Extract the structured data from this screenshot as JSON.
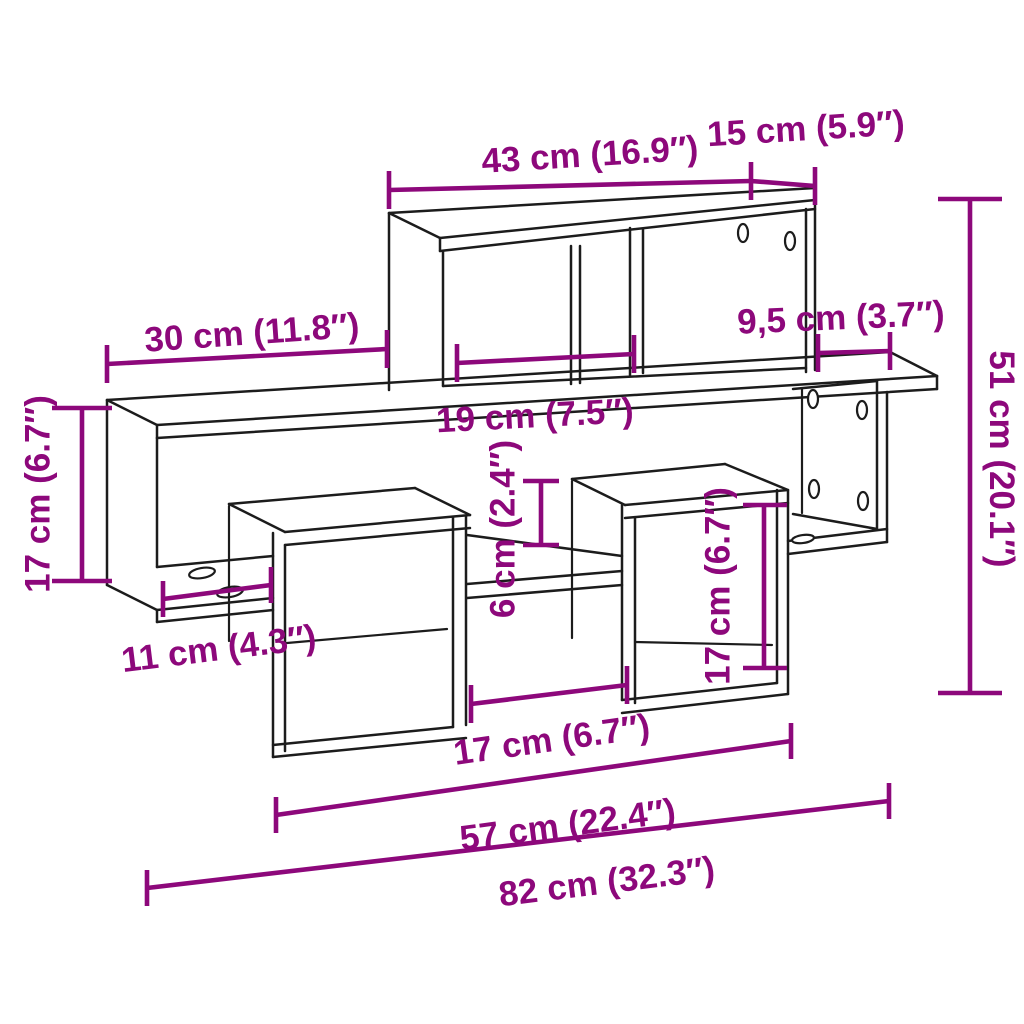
{
  "diagram": {
    "title": "Wall shelf dimension diagram",
    "colors": {
      "background": "#ffffff",
      "line": "#1c1c1c",
      "dimension": "#8d087b"
    },
    "units": {
      "metric": "cm",
      "imperial": "in"
    },
    "dims": [
      {
        "id": "top-shelf-width",
        "value_cm": "43",
        "value_in": "16.9",
        "label": "43 cm (16.9″)"
      },
      {
        "id": "top-right-width",
        "value_cm": "15",
        "value_in": "5.9",
        "label": "15 cm (5.9″)"
      },
      {
        "id": "left-shelf-width",
        "value_cm": "30",
        "value_in": "11.8",
        "label": "30 cm (11.8″)"
      },
      {
        "id": "right-overhang-width",
        "value_cm": "9,5",
        "value_in": "3.7",
        "label": "9,5 cm (3.7″)"
      },
      {
        "id": "middle-compartment",
        "value_cm": "19",
        "value_in": "7.5",
        "label": "19 cm (7.5″)"
      },
      {
        "id": "left-side-height",
        "value_cm": "17",
        "value_in": "6.7",
        "label": "17 cm (6.7″)"
      },
      {
        "id": "total-height",
        "value_cm": "51",
        "value_in": "20.1",
        "label": "51 cm (20.1″)"
      },
      {
        "id": "middle-gap-height",
        "value_cm": "6",
        "value_in": "2.4",
        "label": "6 cm (2.4″)"
      },
      {
        "id": "cube-height",
        "value_cm": "17",
        "value_in": "6.7",
        "label": "17 cm (6.7″)"
      },
      {
        "id": "left-board-width",
        "value_cm": "11",
        "value_in": "4.3",
        "label": "11 cm (4.3″)"
      },
      {
        "id": "between-cubes-width",
        "value_cm": "17",
        "value_in": "6.7",
        "label": "17 cm (6.7″)"
      },
      {
        "id": "inner-span-width",
        "value_cm": "57",
        "value_in": "22.4",
        "label": "57 cm (22.4″)"
      },
      {
        "id": "total-width",
        "value_cm": "82",
        "value_in": "32.3",
        "label": "82 cm (32.3″)"
      }
    ]
  }
}
